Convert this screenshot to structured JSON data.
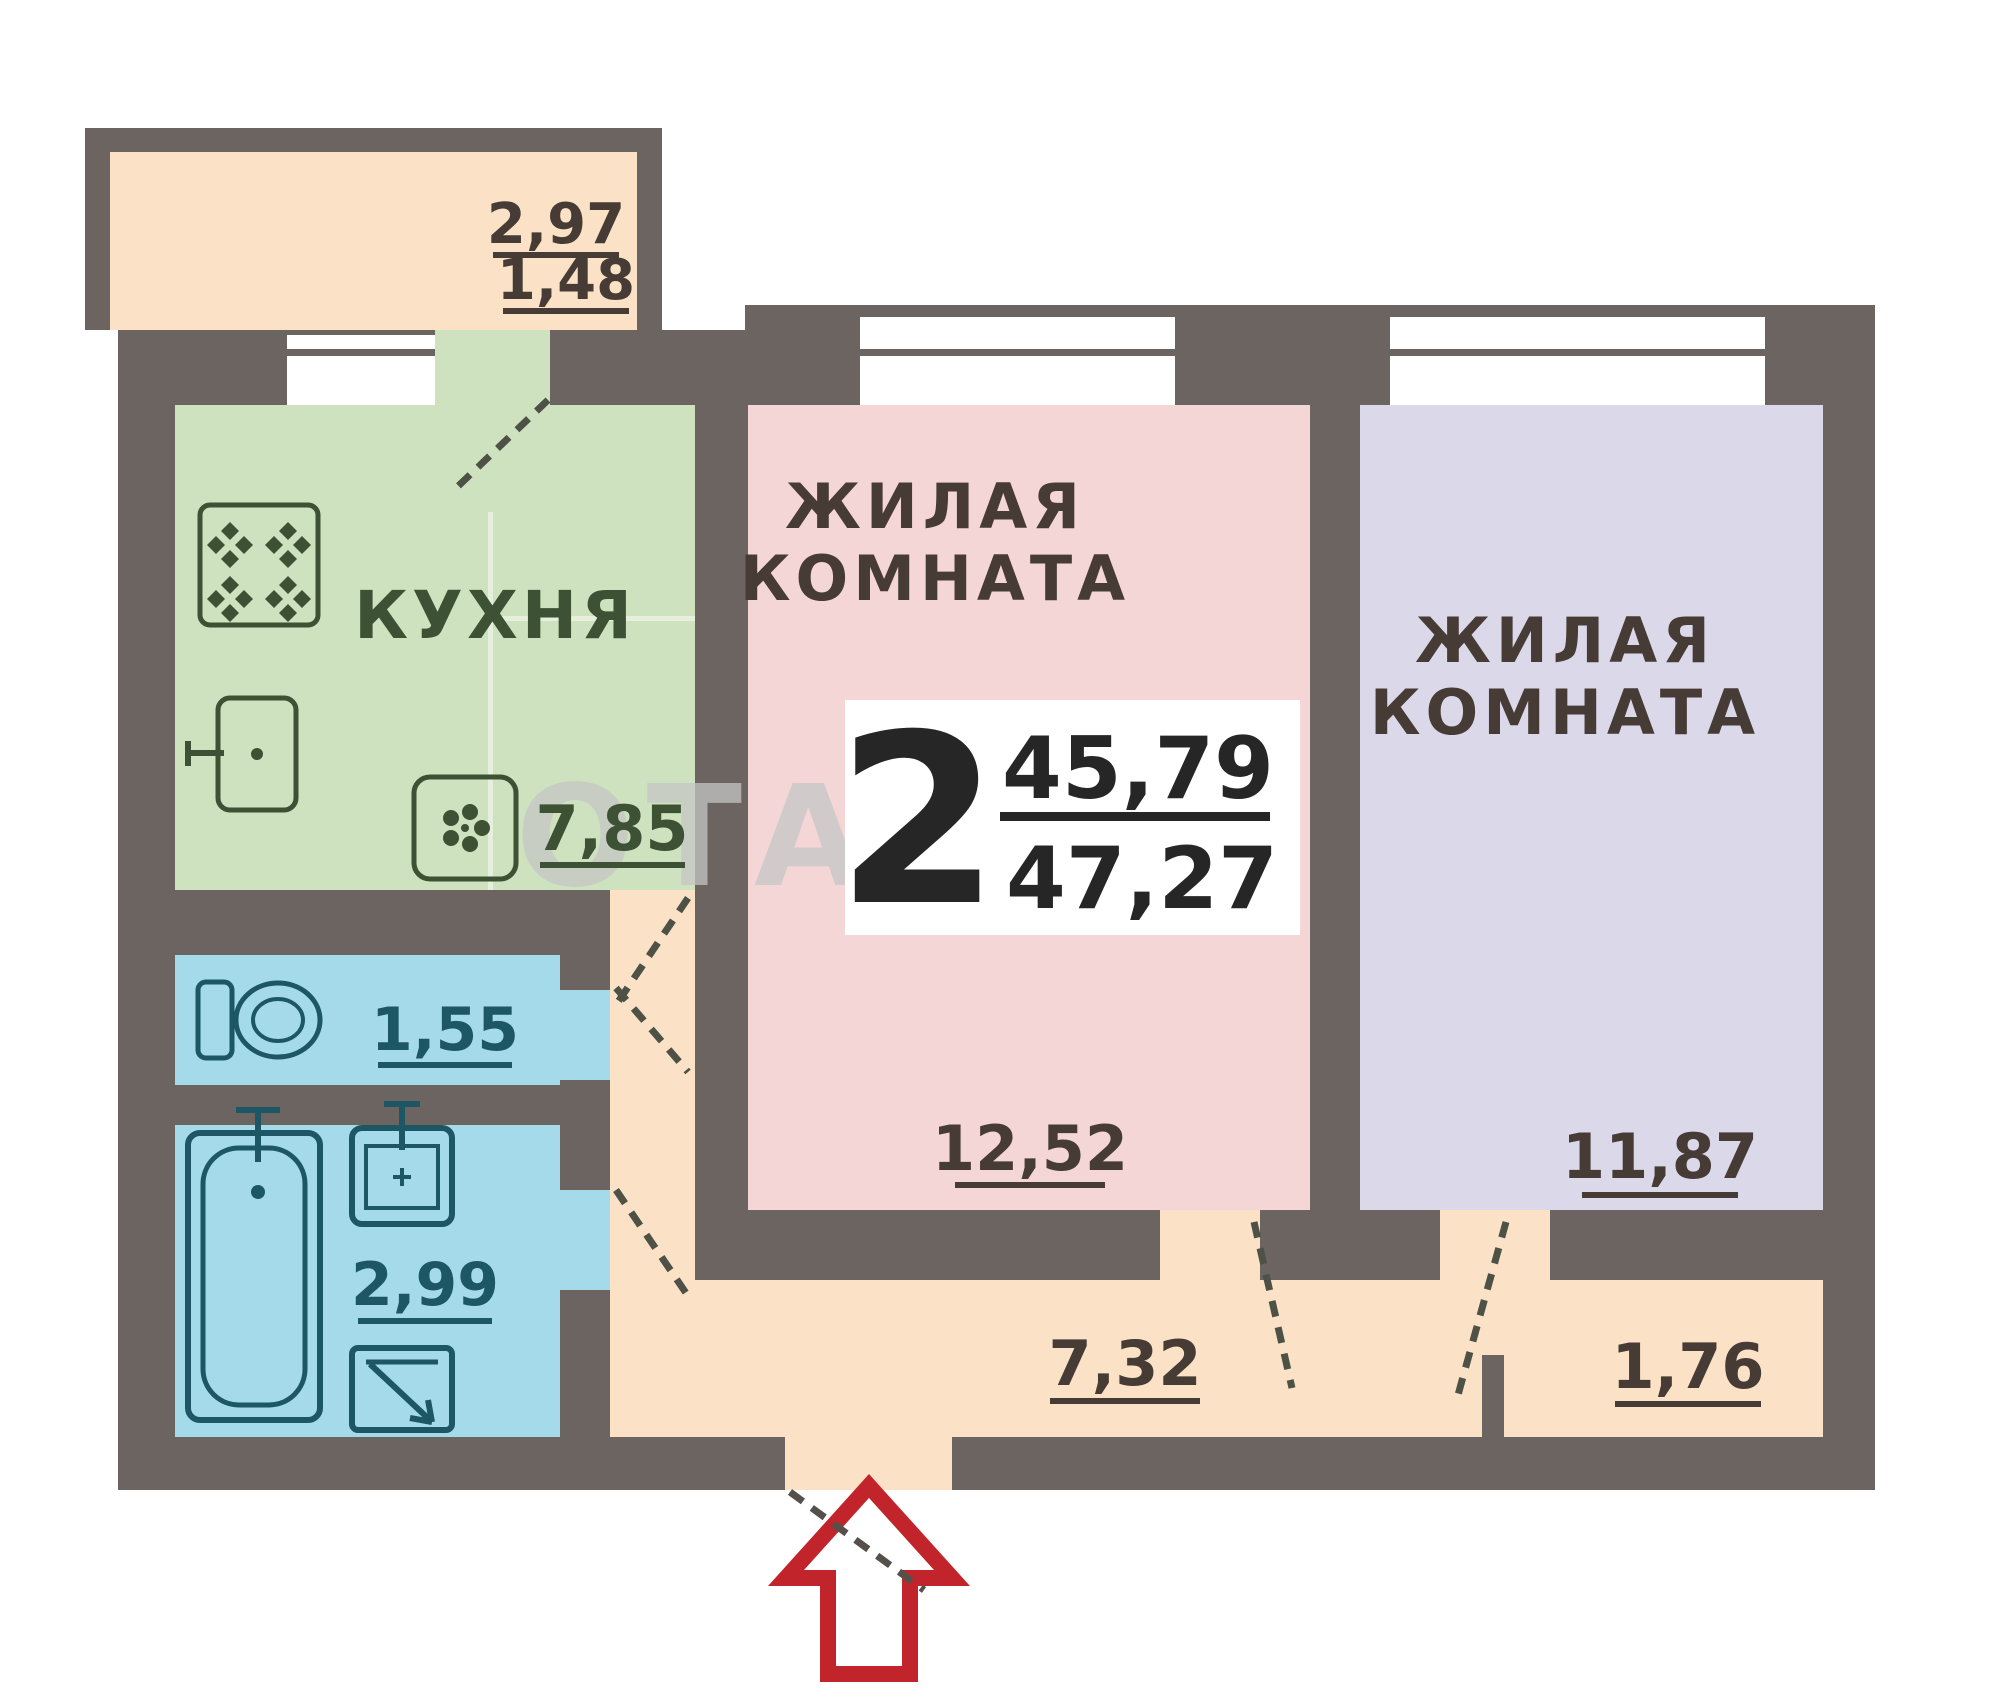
{
  "summary": {
    "rooms_count": "2",
    "living_area": "45,79",
    "total_area": "47,27"
  },
  "rooms": {
    "kitchen": {
      "label": "КУХНЯ",
      "area": "7,85"
    },
    "living_room_1": {
      "label_line1": "ЖИЛАЯ",
      "label_line2": "КОМНАТА",
      "area": "12,52"
    },
    "living_room_2": {
      "label_line1": "ЖИЛАЯ",
      "label_line2": "КОМНАТА",
      "area": "11,87"
    },
    "toilet": {
      "area": "1,55"
    },
    "bathroom": {
      "area": "2,99"
    },
    "hallway": {
      "area": "7,32"
    },
    "storage": {
      "area": "1,76"
    },
    "balcony": {
      "width": "2,97",
      "area": "1,48"
    }
  },
  "watermark": {
    "text": "ОТА"
  },
  "icons": {
    "stove-icon": "square with four clover burners",
    "kitchen-sink-icon": "rounded rect with tap",
    "ventilation-icon": "rounded square with flower",
    "toilet-icon": "tank and oval bowl",
    "bathtub-icon": "double rounded rectangle with tap and drain",
    "bathroom-sink-icon": "square basin with tap",
    "washing-machine-icon": "square with diagonal arrow",
    "entrance-arrow-icon": "red outlined block arrow pointing up"
  },
  "colors": {
    "wall": "#6b6460",
    "kitchen_floor": "#cfe2bf",
    "living_room_1_floor": "#f5d6d6",
    "living_room_2_floor": "#dbd8ea",
    "wet_room_floor": "#a5daea",
    "hallway_floor": "#fbe2c6",
    "balcony_floor": "#fbe2c6",
    "kitchen_ink": "#3d5135",
    "wet_ink": "#1d5766",
    "room_ink": "#463c35",
    "summary_ink": "#262626",
    "arrow_red": "#c2242c",
    "watermark_gray": "#c6c6c6"
  }
}
